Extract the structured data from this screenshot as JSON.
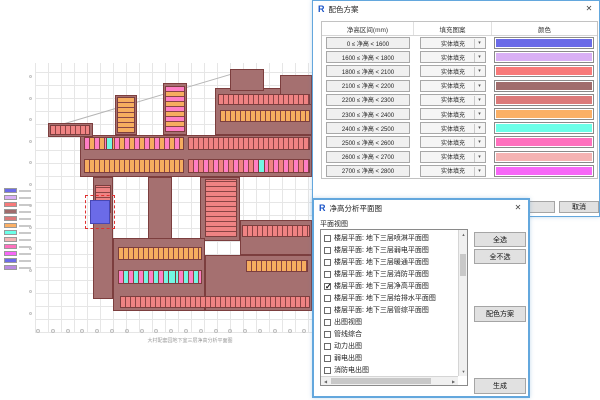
{
  "icons": {
    "app": "R",
    "close": "✕",
    "dropdown_arrow": "▾",
    "arrow_up": "▲",
    "arrow_down": "▼",
    "arrow_left": "◀",
    "arrow_right": "▶"
  },
  "color_scheme_dialog": {
    "title": "配色方案",
    "columns": [
      "净高区间(mm)",
      "填充图案",
      "颜色"
    ],
    "rows": [
      {
        "range": "0 ≤ 净高 < 1600",
        "pattern": "实体填充",
        "color": "#6b6be8"
      },
      {
        "range": "1600 ≤ 净高 < 1800",
        "pattern": "实体填充",
        "color": "#d9aff5"
      },
      {
        "range": "1800 ≤ 净高 < 2100",
        "pattern": "实体填充",
        "color": "#f87a7a"
      },
      {
        "range": "2100 ≤ 净高 < 2200",
        "pattern": "实体填充",
        "color": "#a06c6c"
      },
      {
        "range": "2200 ≤ 净高 < 2300",
        "pattern": "实体填充",
        "color": "#dc7a7a"
      },
      {
        "range": "2300 ≤ 净高 < 2400",
        "pattern": "实体填充",
        "color": "#fbb066"
      },
      {
        "range": "2400 ≤ 净高 < 2500",
        "pattern": "实体填充",
        "color": "#6bffe8"
      },
      {
        "range": "2500 ≤ 净高 < 2600",
        "pattern": "实体填充",
        "color": "#ff70be"
      },
      {
        "range": "2600 ≤ 净高 < 2700",
        "pattern": "实体填充",
        "color": "#f5b3b3"
      },
      {
        "range": "2700 ≤ 净高 < 2800",
        "pattern": "实体填充",
        "color": "#f767f7"
      }
    ],
    "ok_label": "",
    "cancel_label": "取消"
  },
  "plan_views_dialog": {
    "title": "净高分析平面图",
    "group_label": "平面视图",
    "items": [
      {
        "label": "楼层平面: 地下三层喷淋平面图",
        "mark": ""
      },
      {
        "label": "楼层平面: 地下三层弱电平面图",
        "mark": ""
      },
      {
        "label": "楼层平面: 地下三层暖通平面图",
        "mark": ""
      },
      {
        "label": "楼层平面: 地下三层消防平面图",
        "mark": ""
      },
      {
        "label": "楼层平面: 地下三层净高平面图",
        "mark": "✓"
      },
      {
        "label": "楼层平面: 地下三层给排水平面图",
        "mark": ""
      },
      {
        "label": "楼层平面: 地下三层管综平面图",
        "mark": ""
      },
      {
        "label": "出图视图",
        "mark": ""
      },
      {
        "label": "管线综合",
        "mark": ""
      },
      {
        "label": "动力出图",
        "mark": ""
      },
      {
        "label": "弱电出图",
        "mark": ""
      },
      {
        "label": "消防电出图",
        "mark": ""
      }
    ],
    "buttons": {
      "select_all": "全选",
      "select_none": "全不选",
      "color_scheme": "配色方案",
      "generate": "生成"
    }
  },
  "drawing": {
    "caption": "大村配套园地下室三层净高分析平面图",
    "highlight_color": "#6b6be8",
    "legend_colors": [
      "#6b6be8",
      "#d9aff5",
      "#f87a7a",
      "#a06c6c",
      "#dc7a7a",
      "#fbb066",
      "#6bffe8",
      "#f3b5b5",
      "#ff70be",
      "#f767f7",
      "#6b6be8",
      "#b98ae0"
    ]
  }
}
